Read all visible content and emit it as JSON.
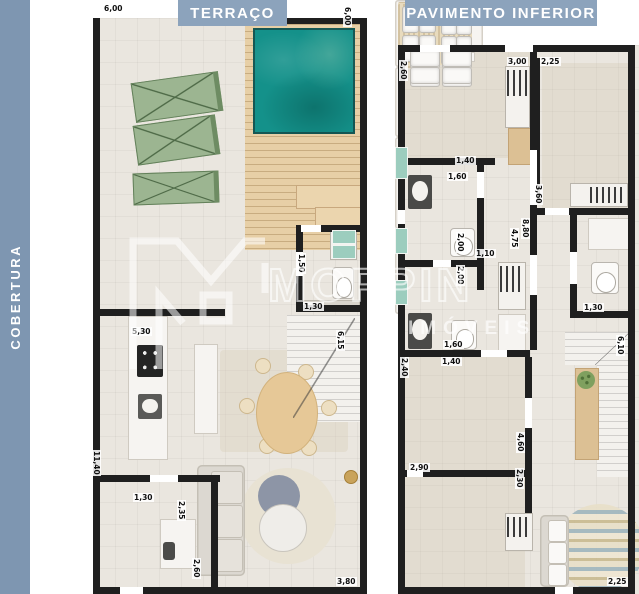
{
  "sidebar": {
    "label": "COBERTURA"
  },
  "watermark": {
    "brand": "MOPPIN",
    "sub": "IMÓVEIS",
    "logo_icon": "m-house-logo"
  },
  "colors": {
    "sidebar": "#7E96B1",
    "badge": "#8CA3BC",
    "floor": "#EAE6DF",
    "wall": "#1F1F1F",
    "pool_water": "#14918A",
    "wood_deck": "#E7CFA6",
    "lounger_green": "#9CB591",
    "glass_teal": "#9CCDBE",
    "accent_gold": "#C9A35B",
    "table_gray_blue": "#8D95A6"
  },
  "plans": [
    {
      "id": "terraco",
      "title": "TERRAÇO",
      "labels": [
        {
          "t": "6,00",
          "x": 10,
          "y": 4,
          "r": 0
        },
        {
          "t": "6,00",
          "x": 250,
          "y": 6,
          "r": 90
        },
        {
          "t": "1,50",
          "x": 204,
          "y": 253,
          "r": 90
        },
        {
          "t": "1,30",
          "x": 210,
          "y": 302,
          "r": 0
        },
        {
          "t": "6,15",
          "x": 243,
          "y": 330,
          "r": 90
        },
        {
          "t": "5,30",
          "x": 38,
          "y": 327,
          "r": 0
        },
        {
          "t": "11,40",
          "x": -1,
          "y": 450,
          "r": 90
        },
        {
          "t": "1,30",
          "x": 40,
          "y": 493,
          "r": 0
        },
        {
          "t": "2,35",
          "x": 84,
          "y": 500,
          "r": 90
        },
        {
          "t": "2,60",
          "x": 99,
          "y": 558,
          "r": 90
        },
        {
          "t": "3,80",
          "x": 243,
          "y": 577,
          "r": 0
        }
      ]
    },
    {
      "id": "pavimento-inferior",
      "title": "PAVIMENTO INFERIOR",
      "labels": [
        {
          "t": "2,60",
          "x": 4,
          "y": 60,
          "r": 90
        },
        {
          "t": "3,00",
          "x": 112,
          "y": 57,
          "r": 0
        },
        {
          "t": "2,25",
          "x": 145,
          "y": 57,
          "r": 0
        },
        {
          "t": "1,40",
          "x": 60,
          "y": 156,
          "r": 0
        },
        {
          "t": "1,60",
          "x": 52,
          "y": 172,
          "r": 0
        },
        {
          "t": "3,60",
          "x": 139,
          "y": 184,
          "r": 90
        },
        {
          "t": "2,00",
          "x": 61,
          "y": 232,
          "r": 90
        },
        {
          "t": "1,10",
          "x": 80,
          "y": 249,
          "r": 0
        },
        {
          "t": "2,00",
          "x": 61,
          "y": 265,
          "r": 90
        },
        {
          "t": "4,75",
          "x": 115,
          "y": 228,
          "r": 90
        },
        {
          "t": "8,80",
          "x": 126,
          "y": 218,
          "r": 90
        },
        {
          "t": "1,30",
          "x": 188,
          "y": 303,
          "r": 0
        },
        {
          "t": "6,10",
          "x": 221,
          "y": 335,
          "r": 90
        },
        {
          "t": "1,60",
          "x": 48,
          "y": 340,
          "r": 0
        },
        {
          "t": "1,40",
          "x": 46,
          "y": 357,
          "r": 0
        },
        {
          "t": "2,40",
          "x": 5,
          "y": 357,
          "r": 90
        },
        {
          "t": "2,90",
          "x": 14,
          "y": 463,
          "r": 0
        },
        {
          "t": "4,60",
          "x": 121,
          "y": 432,
          "r": 90
        },
        {
          "t": "2,30",
          "x": 120,
          "y": 468,
          "r": 90
        },
        {
          "t": "2,25",
          "x": 212,
          "y": 577,
          "r": 0
        }
      ]
    }
  ]
}
